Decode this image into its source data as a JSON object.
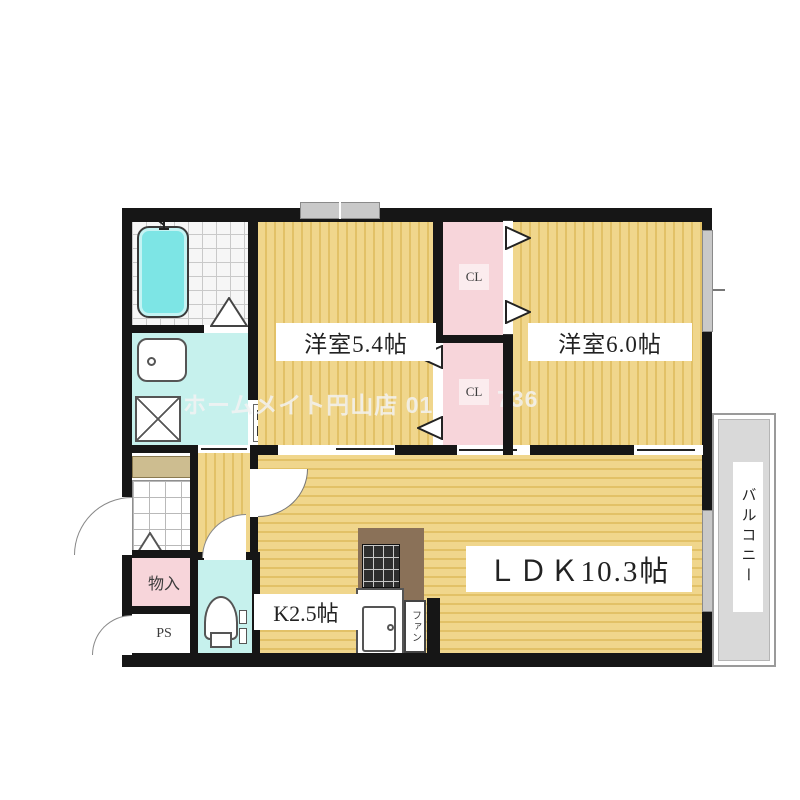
{
  "floorplan": {
    "rooms": {
      "bedroom1": {
        "label": "洋室5.4帖"
      },
      "bedroom2": {
        "label": "洋室6.0帖"
      },
      "ldk": {
        "label": "ＬＤＫ10.3帖"
      },
      "kitchen": {
        "label": "K2.5帖"
      },
      "closet_upper": {
        "label": "CL"
      },
      "closet_lower": {
        "label": "CL"
      },
      "storage": {
        "label": "物入"
      },
      "pipe_space": {
        "label": "PS"
      },
      "balcony": {
        "label": "バルコニー"
      }
    },
    "fixtures": {
      "range_fan_label": "ファン"
    },
    "watermark": {
      "left": "ホームメイト円山店 01",
      "right": "736"
    },
    "colors": {
      "floor_yellow": "#f0d68c",
      "floor_line": "#e2c167",
      "closet_pink": "#f7d5da",
      "wet_area_cyan": "#c6f1ed",
      "bathtub_cyan": "#7de5e5",
      "wall_black": "#161616",
      "balcony_gray": "#d9d9d9",
      "counter_brown": "#8a7158"
    }
  }
}
